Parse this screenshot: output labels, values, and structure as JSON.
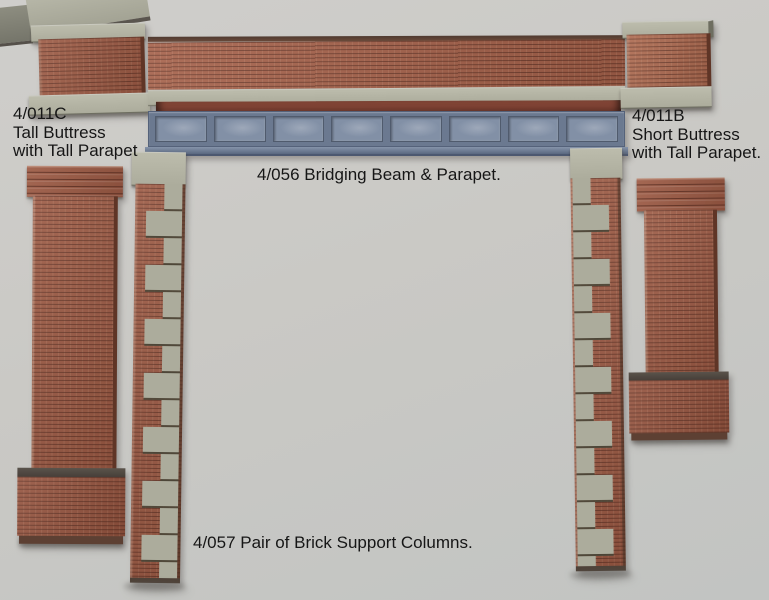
{
  "palette": {
    "background": "#cac9c5",
    "brick": "#9c5a44",
    "brick_light": "#ad6a50",
    "brick_parapet": "#a5614a",
    "brick_shadow": "#5f3526",
    "concrete": "#acac9c",
    "concrete_light": "#bcbcac",
    "steel": "#6b7990",
    "steel_panel": "#8290a6",
    "steel_dark": "#55627a",
    "red_strip": "#6e382c",
    "slope_dark": "#473f39",
    "text": "#161616"
  },
  "beam": {
    "panel_count": 8
  },
  "labels": {
    "tall_buttress": {
      "code": "4/011C",
      "line2": "Tall Buttress",
      "line3": "with Tall Parapet"
    },
    "short_buttress": {
      "code": "4/011B",
      "line2": "Short Buttress",
      "line3": "with Tall Parapet."
    },
    "bridging_beam": {
      "text": "4/056 Bridging Beam & Parapet."
    },
    "support_columns": {
      "text": "4/057 Pair of Brick Support Columns."
    }
  }
}
